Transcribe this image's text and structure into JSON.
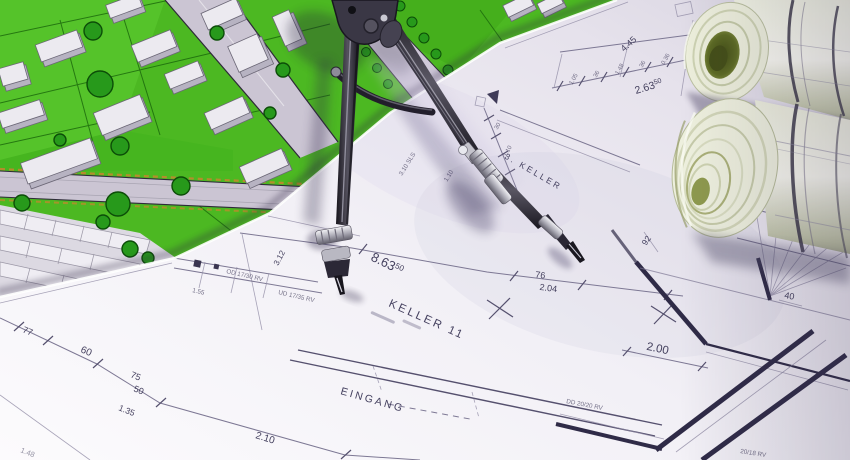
{
  "scene_title": "Architectural blueprints with drawing compass and rolled plans on a site map",
  "blueprint": {
    "rooms": {
      "keller11": "KELLER 11",
      "keller3": "3. KELLER",
      "eingang": "EINGANG"
    },
    "dims": {
      "d863": "8.63",
      "d863sup": "50",
      "d263": "2.63",
      "d263sup": "50",
      "d445": "4.45",
      "d312": "3.12",
      "d76": "76",
      "d204": "2.04",
      "d200": "2.00",
      "d210": "2.10",
      "d40": "40",
      "d92": "92",
      "d77": "77",
      "d60": "60",
      "d75": "75",
      "d50": "50",
      "d135": "1.35",
      "d148": "1.48"
    },
    "chain_top": [
      "1.05",
      "36",
      "1.48",
      "36",
      "0.36"
    ],
    "chain_left": [
      "30",
      "1.10"
    ],
    "notes": {
      "n1": "OD 17/30 RV",
      "n2": "UD 17/35 RV",
      "n3": "1.55",
      "n4": "DD 20/20 RV",
      "n5": "20/18 RV",
      "n6": "3.10 SLS",
      "n7": "1.10"
    }
  },
  "colors": {
    "paper": "#f4f3f7",
    "plan_line": "#7d7894",
    "plan_wall": "#2f2b47",
    "plan_ink": "#433f5e",
    "map_grass": "#4cb822",
    "map_tree": "#27991b",
    "map_road": "#cbc5d3",
    "map_dash_accent": "#c8862e",
    "metal_dark": "#23202b",
    "metal_light": "#d8d8de",
    "roll_paper": "#eef0de",
    "roll_core_olive": "#5d6b24"
  }
}
